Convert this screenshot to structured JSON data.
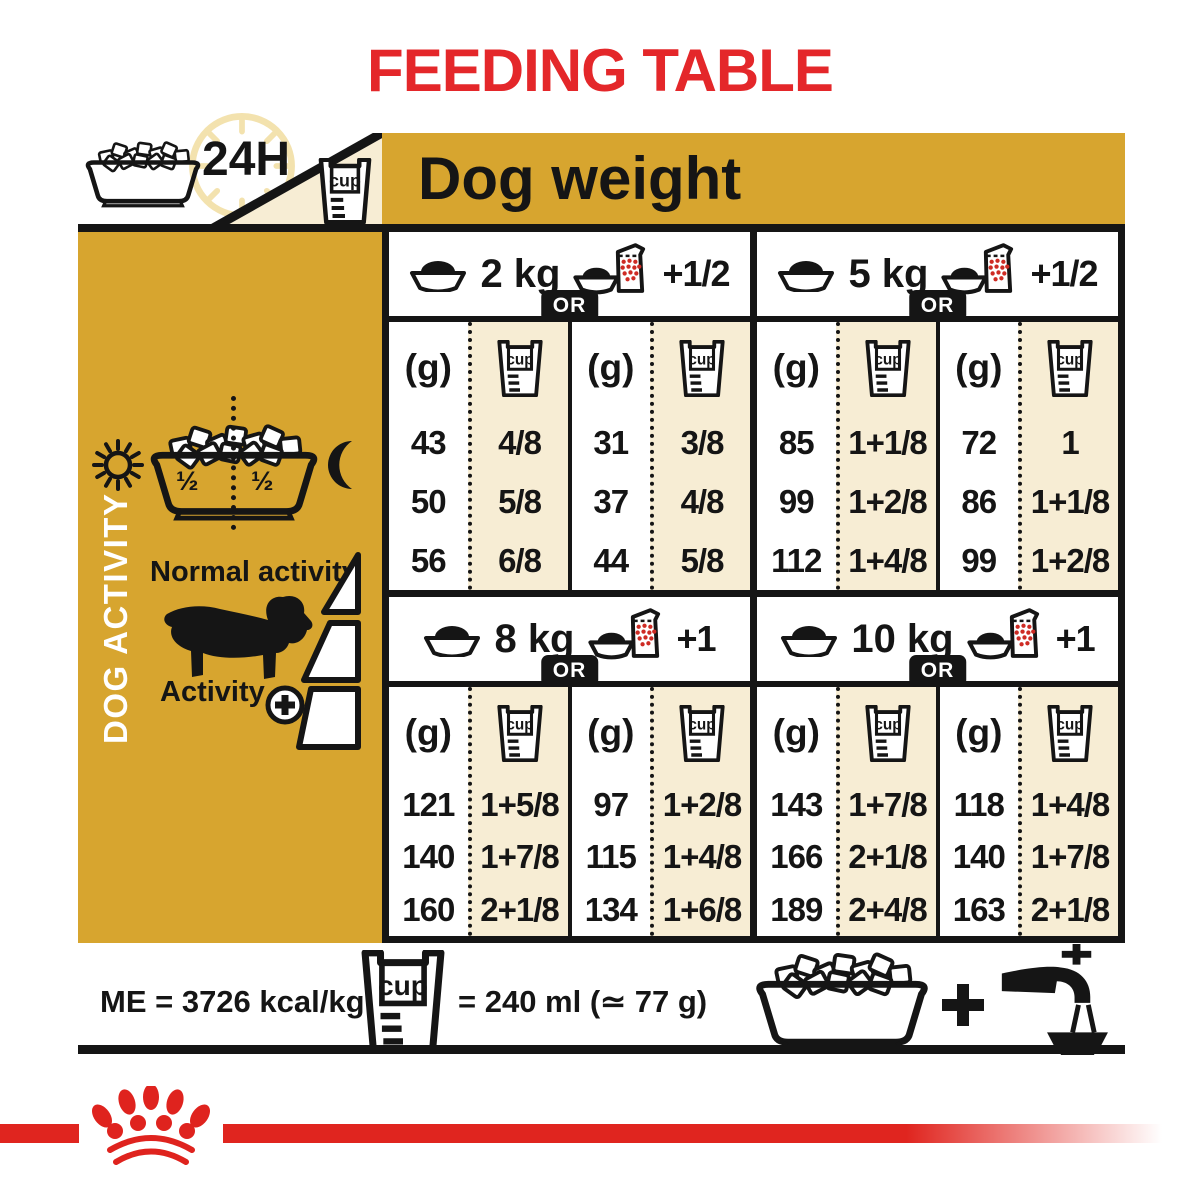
{
  "page": {
    "title": "FEEDING TABLE"
  },
  "header": {
    "clock_label": "24H",
    "dog_weight": "Dog weight"
  },
  "labels": {
    "cup": "cup",
    "grams": "(g)",
    "or": "OR"
  },
  "sidebar": {
    "vertical_label": "DOG ACTIVITY",
    "normal_activity": "Normal activity",
    "activity": "Activity",
    "half_left": "½",
    "half_right": "½"
  },
  "footer": {
    "me": "ME = 3726 kcal/kg",
    "cup_eq": "= 240 ml (≃ 77 g)"
  },
  "colors": {
    "gold": "#D7A52F",
    "cream": "#F7EDD4",
    "red": "#E4272A",
    "red_bar": "#E0251F",
    "dark": "#151515",
    "pale_gold": "#F3E2AE"
  },
  "icons": {
    "clock": "clock-icon",
    "bowl": "bowl-icon",
    "cup": "measuring-cup-icon",
    "pouch": "wet-food-pouch-icon",
    "sun": "sun-icon",
    "moon": "moon-icon",
    "dog": "dachshund-icon",
    "plus": "plus-icon",
    "tap": "water-tap-icon",
    "crown": "royal-canin-crown-logo"
  },
  "chart_data": {
    "type": "table",
    "title": "FEEDING TABLE",
    "column_header": "Dog weight",
    "row_meaning": "three rows per weight = increasing dog activity (normal to high)",
    "legend": "left column of each pair = dry food only; right column = dry food + wet pouch supplement",
    "weights": [
      {
        "weight_label": "2 kg",
        "extra_label": "+1/2",
        "dry_only": {
          "grams": [
            43,
            50,
            56
          ],
          "cups": [
            "4/8",
            "5/8",
            "6/8"
          ]
        },
        "with_wet": {
          "grams": [
            31,
            37,
            44
          ],
          "cups": [
            "3/8",
            "4/8",
            "5/8"
          ]
        }
      },
      {
        "weight_label": "5 kg",
        "extra_label": "+1/2",
        "dry_only": {
          "grams": [
            85,
            99,
            112
          ],
          "cups": [
            "1+1/8",
            "1+2/8",
            "1+4/8"
          ]
        },
        "with_wet": {
          "grams": [
            72,
            86,
            99
          ],
          "cups": [
            "1",
            "1+1/8",
            "1+2/8"
          ]
        }
      },
      {
        "weight_label": "8 kg",
        "extra_label": "+1",
        "dry_only": {
          "grams": [
            121,
            140,
            160
          ],
          "cups": [
            "1+5/8",
            "1+7/8",
            "2+1/8"
          ]
        },
        "with_wet": {
          "grams": [
            97,
            115,
            134
          ],
          "cups": [
            "1+2/8",
            "1+4/8",
            "1+6/8"
          ]
        }
      },
      {
        "weight_label": "10 kg",
        "extra_label": "+1",
        "dry_only": {
          "grams": [
            143,
            166,
            189
          ],
          "cups": [
            "1+7/8",
            "2+1/8",
            "2+4/8"
          ]
        },
        "with_wet": {
          "grams": [
            118,
            140,
            163
          ],
          "cups": [
            "1+4/8",
            "1+7/8",
            "2+1/8"
          ]
        }
      }
    ],
    "notes": [
      "ME = 3726 kcal/kg",
      "cup = 240 ml (≃ 77 g)"
    ]
  }
}
